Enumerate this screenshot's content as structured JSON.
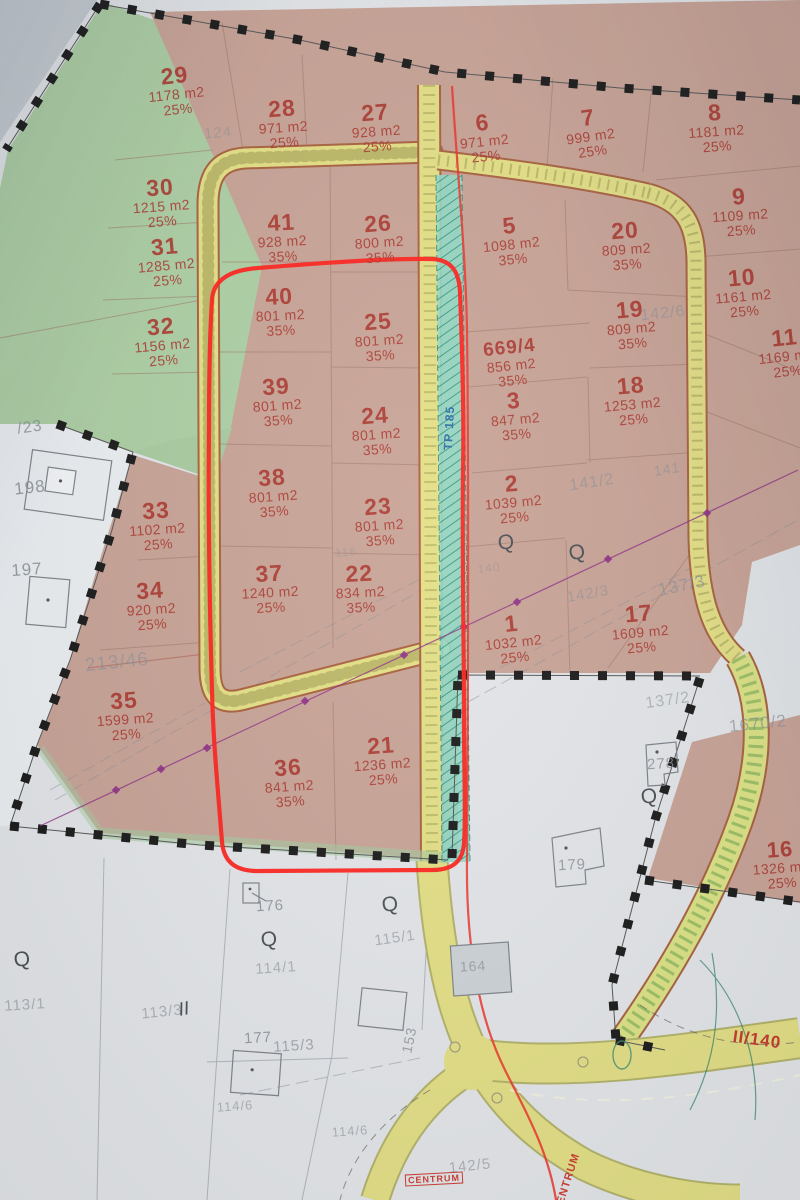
{
  "map_title": "cadastral development plan photo",
  "colors": {
    "parcel_label_red": "#ab382f",
    "outline_red": "#ff221c",
    "road_yellow": "#e3df85",
    "zone_pink": "#c9a396",
    "zone_green": "#adcfa4",
    "corridor_teal": "#93d9c6",
    "boundary_black": "#1a1a1a",
    "gray_label": "#878e96",
    "annotation_blue": "#2e6da6",
    "annotation_red": "#cc3b30"
  },
  "parcels": [
    {
      "n": "29",
      "a": "1178 m2",
      "p": "25%",
      "x": 176,
      "y": 90,
      "r": -6
    },
    {
      "n": "28",
      "a": "971 m2",
      "p": "25%",
      "x": 283,
      "y": 123,
      "r": -4
    },
    {
      "n": "27",
      "a": "928 m2",
      "p": "25%",
      "x": 376,
      "y": 127,
      "r": -4
    },
    {
      "n": "6",
      "a": "971 m2",
      "p": "25%",
      "x": 484,
      "y": 137,
      "r": -6
    },
    {
      "n": "7",
      "a": "999 m2",
      "p": "25%",
      "x": 590,
      "y": 132,
      "r": -8
    },
    {
      "n": "8",
      "a": "1181 m2",
      "p": "25%",
      "x": 716,
      "y": 127,
      "r": -4
    },
    {
      "n": "30",
      "a": "1215 m2",
      "p": "25%",
      "x": 161,
      "y": 202,
      "r": -4
    },
    {
      "n": "31",
      "a": "1285 m2",
      "p": "25%",
      "x": 166,
      "y": 261,
      "r": -5
    },
    {
      "n": "41",
      "a": "928 m2",
      "p": "35%",
      "x": 282,
      "y": 237,
      "r": -3
    },
    {
      "n": "26",
      "a": "800 m2",
      "p": "35%",
      "x": 379,
      "y": 238,
      "r": -4
    },
    {
      "n": "5",
      "a": "1098 m2",
      "p": "35%",
      "x": 511,
      "y": 240,
      "r": -6
    },
    {
      "n": "20",
      "a": "809 m2",
      "p": "35%",
      "x": 626,
      "y": 245,
      "r": -4
    },
    {
      "n": "9",
      "a": "1109 m2",
      "p": "25%",
      "x": 740,
      "y": 211,
      "r": -4
    },
    {
      "n": "10",
      "a": "1161 m2",
      "p": "25%",
      "x": 743,
      "y": 292,
      "r": -5
    },
    {
      "n": "32",
      "a": "1156 m2",
      "p": "25%",
      "x": 162,
      "y": 341,
      "r": -5
    },
    {
      "n": "19",
      "a": "809 m2",
      "p": "35%",
      "x": 631,
      "y": 324,
      "r": -5
    },
    {
      "n": "40",
      "a": "801 m2",
      "p": "35%",
      "x": 280,
      "y": 311,
      "r": -3
    },
    {
      "n": "25",
      "a": "801 m2",
      "p": "35%",
      "x": 379,
      "y": 336,
      "r": -4
    },
    {
      "n": "11",
      "a": "1169 m2",
      "p": "25%",
      "x": 786,
      "y": 352,
      "r": -6
    },
    {
      "n": "669/4",
      "a": "856 m2",
      "p": "35%",
      "x": 511,
      "y": 363,
      "r": -6,
      "ns": 19
    },
    {
      "n": "3",
      "a": "847 m2",
      "p": "35%",
      "x": 515,
      "y": 415,
      "r": -5
    },
    {
      "n": "18",
      "a": "1253 m2",
      "p": "25%",
      "x": 632,
      "y": 400,
      "r": -5
    },
    {
      "n": "39",
      "a": "801 m2",
      "p": "35%",
      "x": 277,
      "y": 401,
      "r": -4
    },
    {
      "n": "24",
      "a": "801 m2",
      "p": "35%",
      "x": 376,
      "y": 430,
      "r": -4
    },
    {
      "n": "38",
      "a": "801 m2",
      "p": "35%",
      "x": 273,
      "y": 492,
      "r": -4
    },
    {
      "n": "23",
      "a": "801 m2",
      "p": "35%",
      "x": 379,
      "y": 521,
      "r": -4
    },
    {
      "n": "2",
      "a": "1039 m2",
      "p": "25%",
      "x": 513,
      "y": 498,
      "r": -5
    },
    {
      "n": "33",
      "a": "1102 m2",
      "p": "25%",
      "x": 157,
      "y": 525,
      "r": -4
    },
    {
      "n": "34",
      "a": "920 m2",
      "p": "25%",
      "x": 151,
      "y": 605,
      "r": -4
    },
    {
      "n": "37",
      "a": "1240 m2",
      "p": "25%",
      "x": 270,
      "y": 588,
      "r": -3
    },
    {
      "n": "22",
      "a": "834 m2",
      "p": "35%",
      "x": 360,
      "y": 588,
      "r": -3
    },
    {
      "n": "1",
      "a": "1032 m2",
      "p": "25%",
      "x": 513,
      "y": 638,
      "r": -6
    },
    {
      "n": "17",
      "a": "1609 m2",
      "p": "25%",
      "x": 640,
      "y": 628,
      "r": -5
    },
    {
      "n": "35",
      "a": "1599 m2",
      "p": "25%",
      "x": 125,
      "y": 715,
      "r": -4
    },
    {
      "n": "36",
      "a": "841 m2",
      "p": "35%",
      "x": 289,
      "y": 782,
      "r": -4
    },
    {
      "n": "21",
      "a": "1236 m2",
      "p": "25%",
      "x": 382,
      "y": 760,
      "r": -4
    },
    {
      "n": "16",
      "a": "1326 m2",
      "p": "25%",
      "x": 781,
      "y": 864,
      "r": -4,
      "ns": 22
    }
  ],
  "gray_labels": [
    {
      "t": "/23",
      "x": 30,
      "y": 428,
      "r": -8,
      "fs": 16,
      "o": 0.8
    },
    {
      "t": "124",
      "x": 218,
      "y": 133,
      "r": -4,
      "fs": 15,
      "o": 0.5
    },
    {
      "t": "198",
      "x": 30,
      "y": 488,
      "r": -6,
      "fs": 17,
      "o": 0.85
    },
    {
      "t": "197",
      "x": 27,
      "y": 570,
      "r": -4,
      "fs": 17,
      "o": 0.85
    },
    {
      "t": "213/46",
      "x": 117,
      "y": 663,
      "r": -6,
      "fs": 19,
      "o": 0.6
    },
    {
      "t": "116",
      "x": 346,
      "y": 552,
      "r": -4,
      "fs": 12,
      "o": 0.45
    },
    {
      "t": "140",
      "x": 489,
      "y": 568,
      "r": -6,
      "fs": 12,
      "o": 0.45
    },
    {
      "t": "141/2",
      "x": 592,
      "y": 483,
      "r": -9,
      "fs": 16,
      "o": 0.6
    },
    {
      "t": "141",
      "x": 667,
      "y": 469,
      "r": -9,
      "fs": 14,
      "o": 0.55
    },
    {
      "t": "142/6",
      "x": 663,
      "y": 314,
      "r": -6,
      "fs": 16,
      "o": 0.55
    },
    {
      "t": "142/3",
      "x": 588,
      "y": 594,
      "r": -10,
      "fs": 15,
      "o": 0.55
    },
    {
      "t": "137/3",
      "x": 682,
      "y": 586,
      "r": -12,
      "fs": 17,
      "o": 0.65
    },
    {
      "t": "137/2",
      "x": 668,
      "y": 701,
      "r": -8,
      "fs": 16,
      "o": 0.55
    },
    {
      "t": "1670/2",
      "x": 758,
      "y": 724,
      "r": -6,
      "fs": 17,
      "o": 0.65
    },
    {
      "t": "176",
      "x": 270,
      "y": 906,
      "r": -3,
      "fs": 15,
      "o": 0.85
    },
    {
      "t": "179",
      "x": 572,
      "y": 865,
      "r": -3,
      "fs": 15,
      "o": 0.8
    },
    {
      "t": "278",
      "x": 661,
      "y": 764,
      "r": -3,
      "fs": 15,
      "o": 0.8
    },
    {
      "t": "164",
      "x": 473,
      "y": 966,
      "r": -3,
      "fs": 14,
      "o": 0.7
    },
    {
      "t": "153",
      "x": 409,
      "y": 1040,
      "r": -78,
      "fs": 14,
      "o": 0.8
    },
    {
      "t": "177",
      "x": 258,
      "y": 1038,
      "r": -3,
      "fs": 15,
      "o": 0.85
    },
    {
      "t": "115/3",
      "x": 294,
      "y": 1046,
      "r": -4,
      "fs": 15,
      "o": 0.7
    },
    {
      "t": "115/1",
      "x": 395,
      "y": 938,
      "r": -8,
      "fs": 15,
      "o": 0.6
    },
    {
      "t": "114/1",
      "x": 276,
      "y": 968,
      "r": -4,
      "fs": 15,
      "o": 0.6
    },
    {
      "t": "114/6",
      "x": 235,
      "y": 1106,
      "r": -4,
      "fs": 13,
      "o": 0.6
    },
    {
      "t": "114/6",
      "x": 350,
      "y": 1131,
      "r": -4,
      "fs": 13,
      "o": 0.6
    },
    {
      "t": "113/1",
      "x": 25,
      "y": 1005,
      "r": -4,
      "fs": 15,
      "o": 0.6
    },
    {
      "t": "113/3",
      "x": 162,
      "y": 1012,
      "r": -6,
      "fs": 15,
      "o": 0.6
    },
    {
      "t": "142/5",
      "x": 470,
      "y": 1166,
      "r": -6,
      "fs": 15,
      "o": 0.6
    }
  ],
  "annotations": [
    {
      "t": "TP 185",
      "x": 449,
      "y": 428,
      "r": -87,
      "fs": 12,
      "c": "#2e6da6",
      "box": false
    },
    {
      "t": "CENTRUM",
      "x": 434,
      "y": 1179,
      "r": -3,
      "fs": 9,
      "c": "#cc3b30",
      "box": true
    },
    {
      "t": "CENTRUM",
      "x": 567,
      "y": 1183,
      "r": -72,
      "fs": 11,
      "c": "#cc3b30",
      "box": false
    },
    {
      "t": "II/140",
      "x": 757,
      "y": 1040,
      "r": 8,
      "fs": 17,
      "c": "#c43a2e",
      "box": false
    }
  ],
  "symbols": {
    "tree_glyph": "Q",
    "meadow_glyph": "II",
    "trees": [
      {
        "x": 506,
        "y": 543,
        "r": -5
      },
      {
        "x": 577,
        "y": 553,
        "r": -10
      },
      {
        "x": 390,
        "y": 905,
        "r": -8
      },
      {
        "x": 269,
        "y": 940,
        "r": -5
      },
      {
        "x": 22,
        "y": 960,
        "r": -8
      },
      {
        "x": 649,
        "y": 797,
        "r": -5
      }
    ],
    "meadows": [
      {
        "x": 184,
        "y": 1010,
        "r": -10
      }
    ]
  }
}
